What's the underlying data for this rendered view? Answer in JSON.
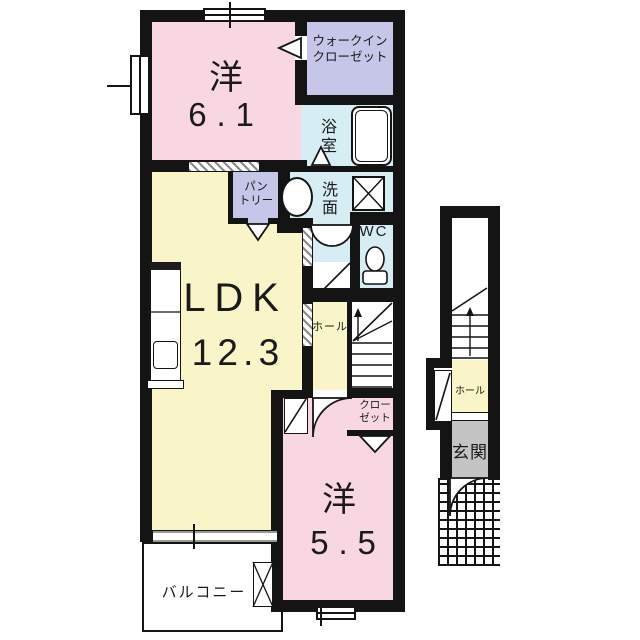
{
  "plan_title": "apartment-floor-plan",
  "palette": {
    "wall": "#141414",
    "room_pink": "#F8D7E3",
    "room_yellow": "#FAF5C8",
    "closet_purple": "#C5C6E8",
    "wet_area_blue": "#D7EDF4",
    "entrance_gray": "#C4C4C4"
  },
  "labels": {
    "bedroom1_name": "洋",
    "bedroom1_size": "6.1",
    "wic_line1": "ウォークイン",
    "wic_line2": "クローゼット",
    "bathroom": "浴室",
    "washroom": "洗面",
    "wc": "WC",
    "pantry_line1": "パン",
    "pantry_line2": "トリー",
    "ldk_name": "LDK",
    "ldk_size": "12.3",
    "hall": "ホール",
    "closet_line1": "クロー",
    "closet_line2": "ゼット",
    "bedroom2_name": "洋",
    "bedroom2_size": "5.5",
    "balcony": "バルコニー",
    "annex_hall": "ホール",
    "entrance": "玄関"
  }
}
